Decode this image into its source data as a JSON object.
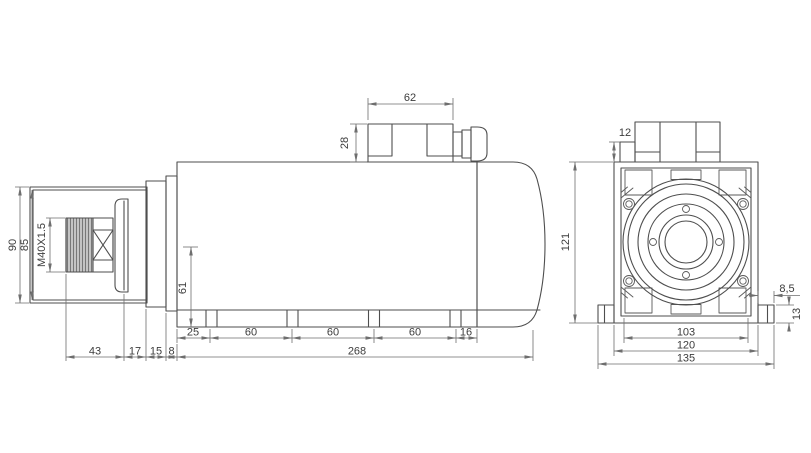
{
  "title": "spindle-motor-dimension-drawing",
  "colors": {
    "background": "#ffffff",
    "line": "#4e4e4e",
    "dimension_line": "#6e6e6e",
    "text": "#3c3c3c",
    "thread_fill": "#c4c4c4"
  },
  "side_view": {
    "dims": {
      "terminal_box_width": "62",
      "terminal_box_height": "28",
      "nose_diameter_outer": "90",
      "nose_diameter_inner": "85",
      "thread_spec": "M40X1.5",
      "center_height": "61",
      "slot_offset": "25",
      "slot_pitch_1": "60",
      "slot_pitch_2": "60",
      "slot_pitch_3": "60",
      "slot_end_offset": "16",
      "overall_length": "268",
      "shaft_length": "43",
      "flange_length": "17",
      "cap_length": "15",
      "step_length": "8"
    }
  },
  "front_view": {
    "dims": {
      "box_step_height": "12",
      "overall_height": "121",
      "foot_overhang": "8,5",
      "foot_height": "13",
      "slot_span": "103",
      "body_width": "120",
      "overall_width": "135"
    }
  }
}
